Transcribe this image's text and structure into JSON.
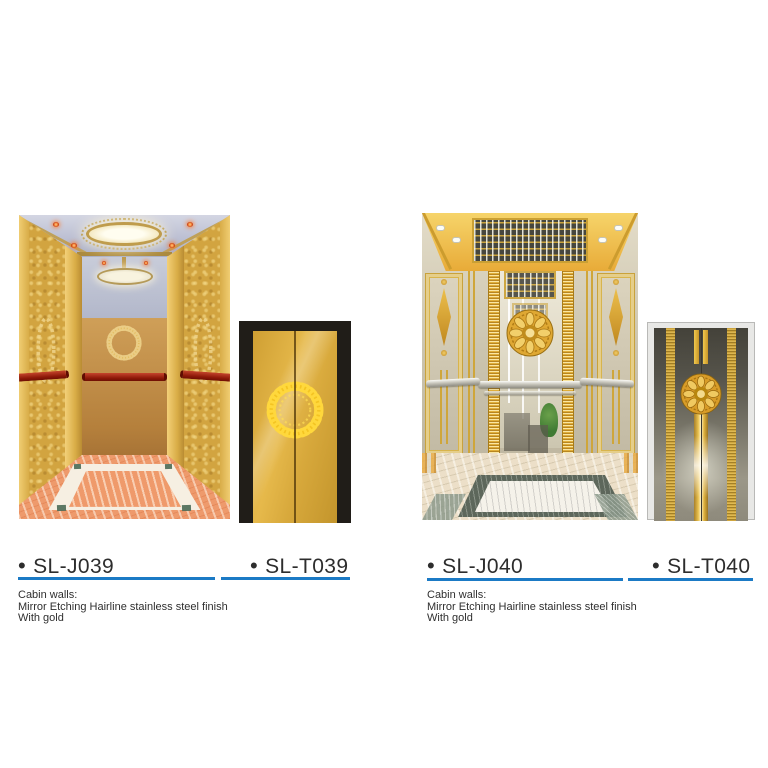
{
  "page": {
    "background": "#ffffff",
    "type": "elevator decoration catalog sheet"
  },
  "bullet": "•",
  "colors": {
    "accent_underline": "#1b7ac5",
    "text": "#2d2d2d",
    "cabin_gold": "#d8ab4a",
    "door_gold": "#e0b243",
    "stainless_gray": "#8e8a7c",
    "handrail_red": "#8c1808",
    "floor_salmon": "#ee9a6c",
    "floor_marble": "#ecdfc8"
  },
  "groups": [
    {
      "cabin_code": "SL-J039",
      "door_code": "SL-T039",
      "cabin_image": "gold elevator cabin, oval ceiling light, red handrails, wreath etched walls, salmon marble floor",
      "door_image": "gold landing door with round wreath ornament, black frame",
      "description_lines": [
        "Cabin walls:",
        "Mirror Etching Hairline stainless steel finish",
        "With gold"
      ]
    },
    {
      "cabin_code": "SL-J040",
      "door_code": "SL-T040",
      "cabin_image": "mirror stainless cabin with gold trims, slat light ceiling, gold medallion, marble floor",
      "door_image": "stainless landing door with gold stripes and medallion",
      "description_lines": [
        "Cabin walls:",
        "Mirror Etching Hairline stainless steel finish",
        "With gold"
      ]
    }
  ]
}
